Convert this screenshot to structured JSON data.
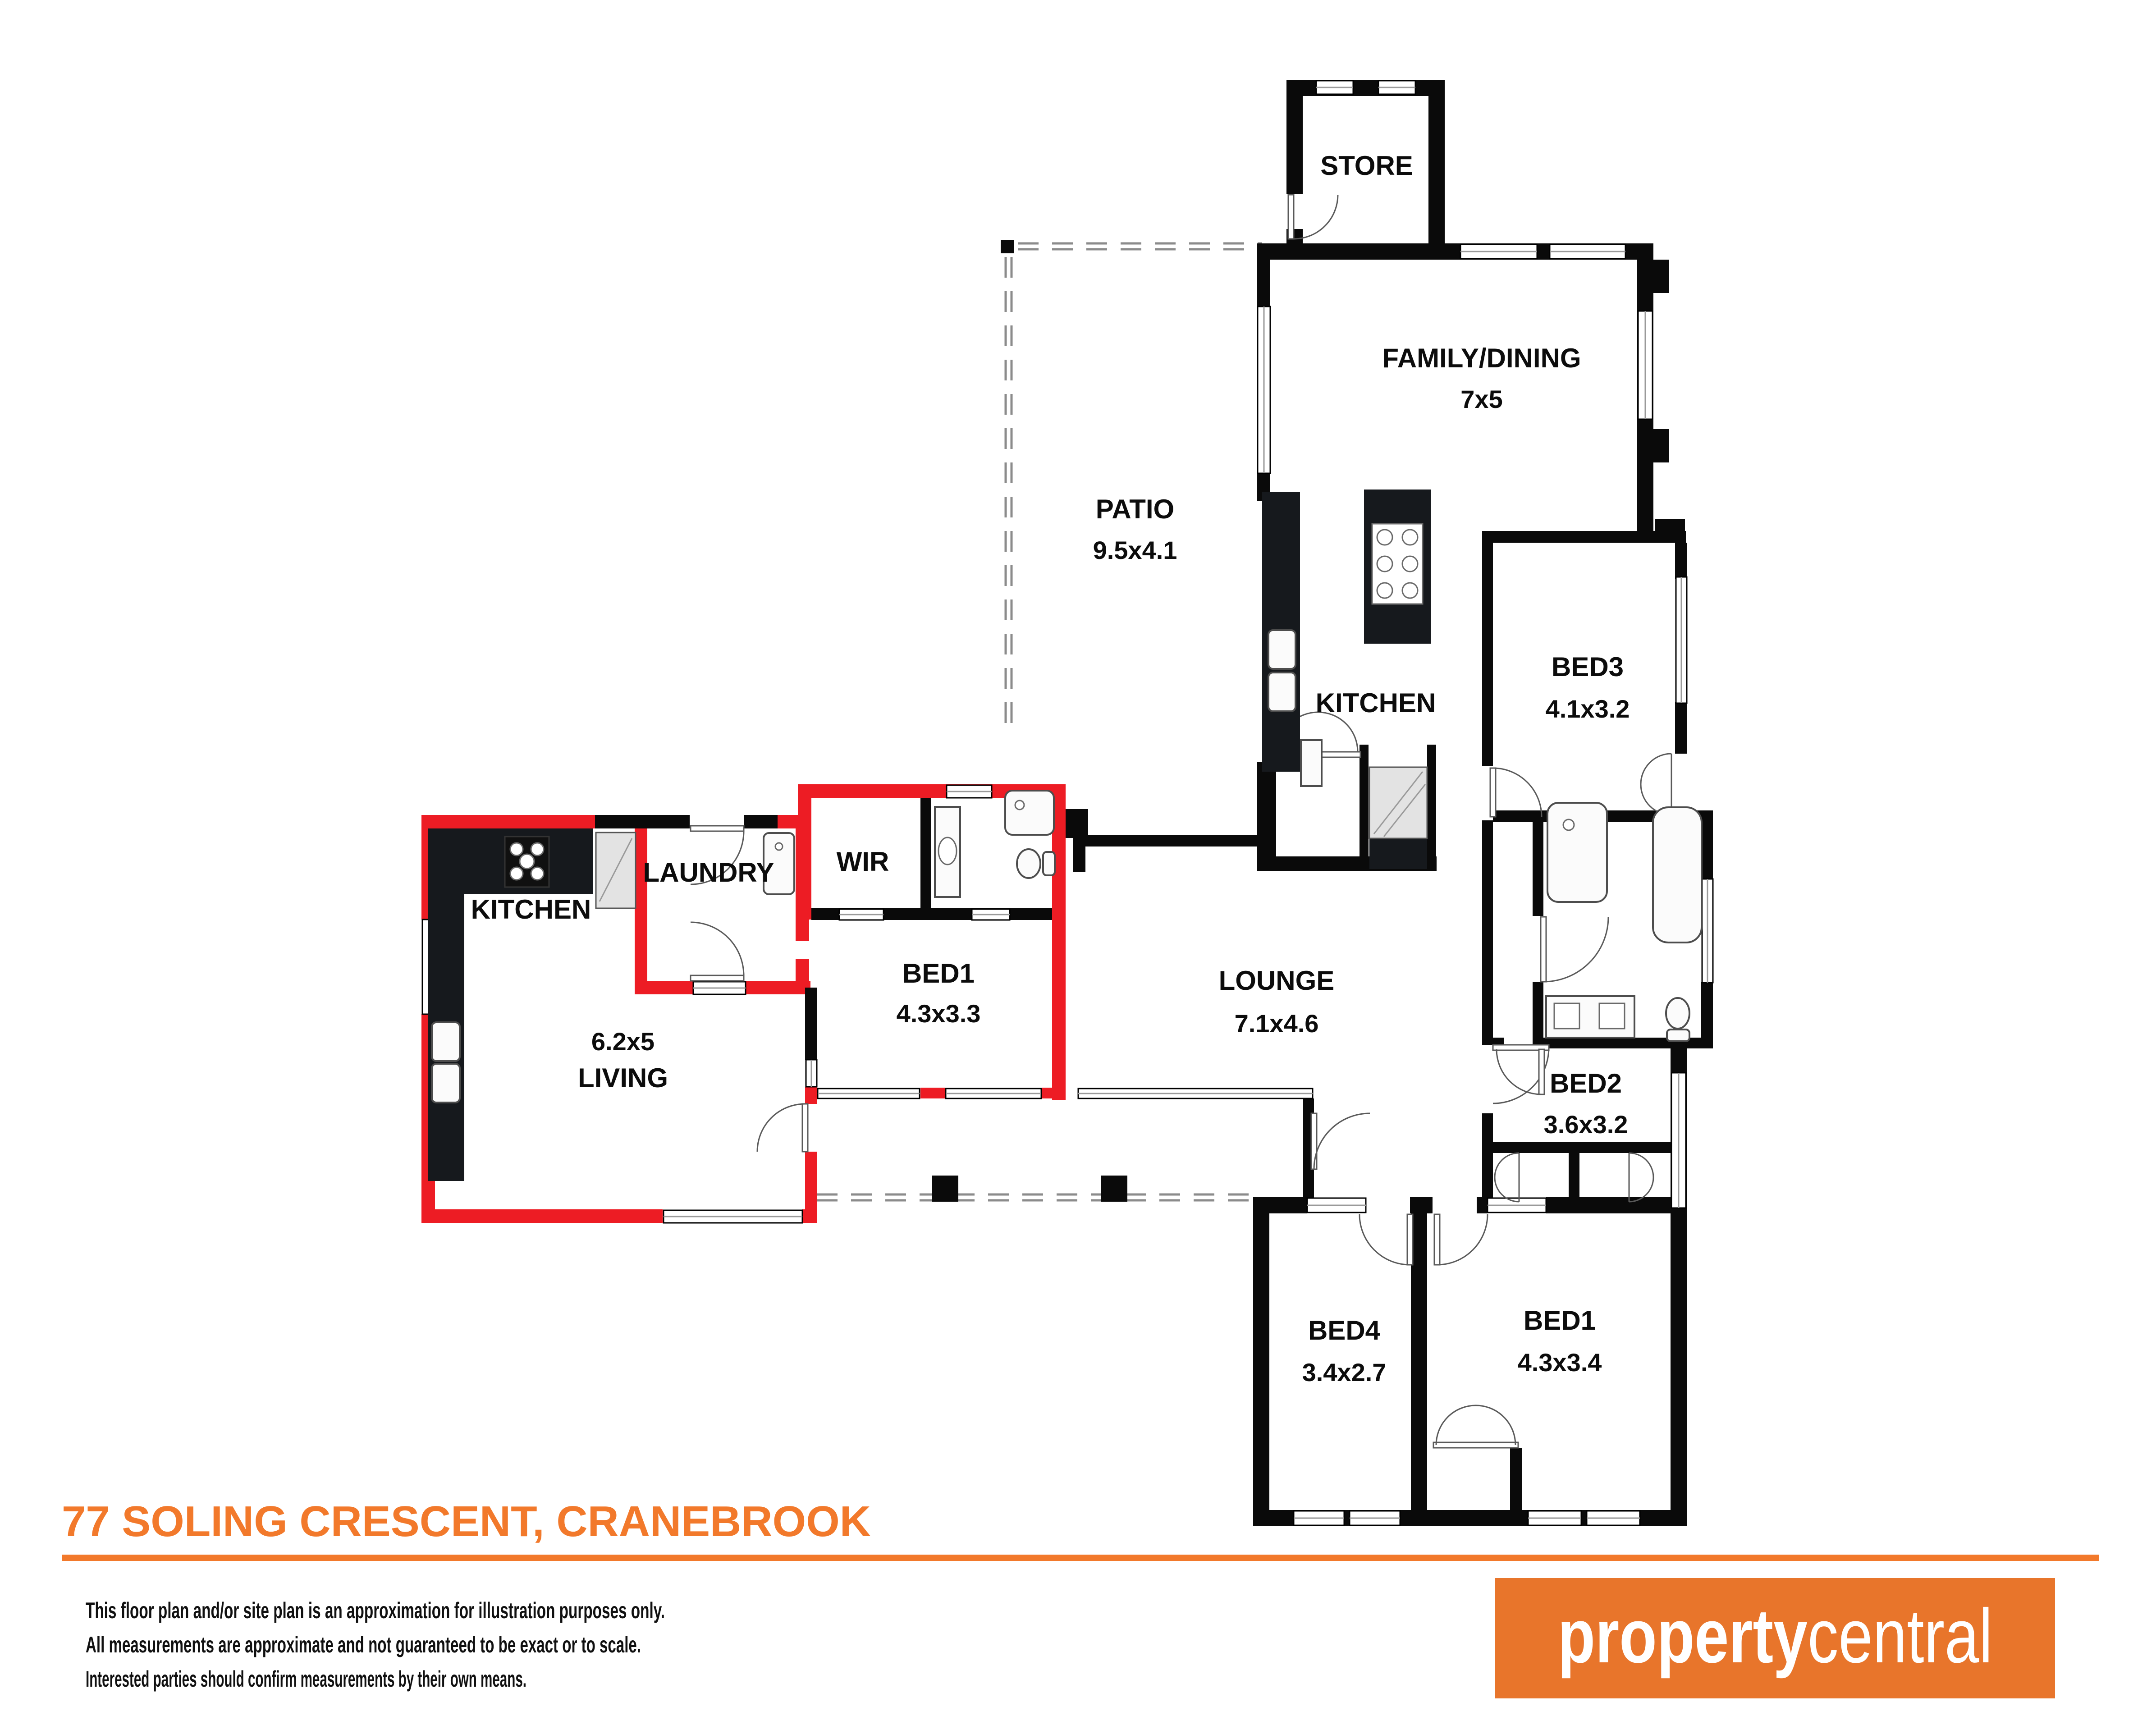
{
  "plan": {
    "rooms": [
      {
        "name": "STORE",
        "dims": ""
      },
      {
        "name": "FAMILY/DINING",
        "dims": "7x5"
      },
      {
        "name": "PATIO",
        "dims": "9.5x4.1"
      },
      {
        "name": "KITCHEN",
        "dims": ""
      },
      {
        "name": "BED3",
        "dims": "4.1x3.2"
      },
      {
        "name": "LOUNGE",
        "dims": "7.1x4.6"
      },
      {
        "name": "BED2",
        "dims": "3.6x3.2"
      },
      {
        "name": "BED1",
        "dims": "4.3x3.4"
      },
      {
        "name": "BED4",
        "dims": "3.4x2.7"
      },
      {
        "name": "KITCHEN",
        "dims": ""
      },
      {
        "name": "LAUNDRY",
        "dims": ""
      },
      {
        "name": "WIR",
        "dims": ""
      },
      {
        "name": "BED1",
        "dims": "4.3x3.3"
      },
      {
        "name": "LIVING",
        "dims": "6.2x5"
      }
    ],
    "colors": {
      "wall": "#0a0a0a",
      "highlight_wall": "#ED1C24",
      "bench": "#16191d",
      "accent": "#F2792B",
      "logo_bg": "#E8752B"
    }
  },
  "footer": {
    "title": "77 SOLING CRESCENT, CRANEBROOK",
    "disclaimer_lines": [
      "This floor plan and/or site plan is an approximation for illustration purposes only.",
      "All measurements are approximate and not guaranteed to be exact or to scale.",
      "Interested parties should confirm measurements by their own means."
    ]
  },
  "logo": {
    "part1": "property",
    "part2": "central"
  }
}
